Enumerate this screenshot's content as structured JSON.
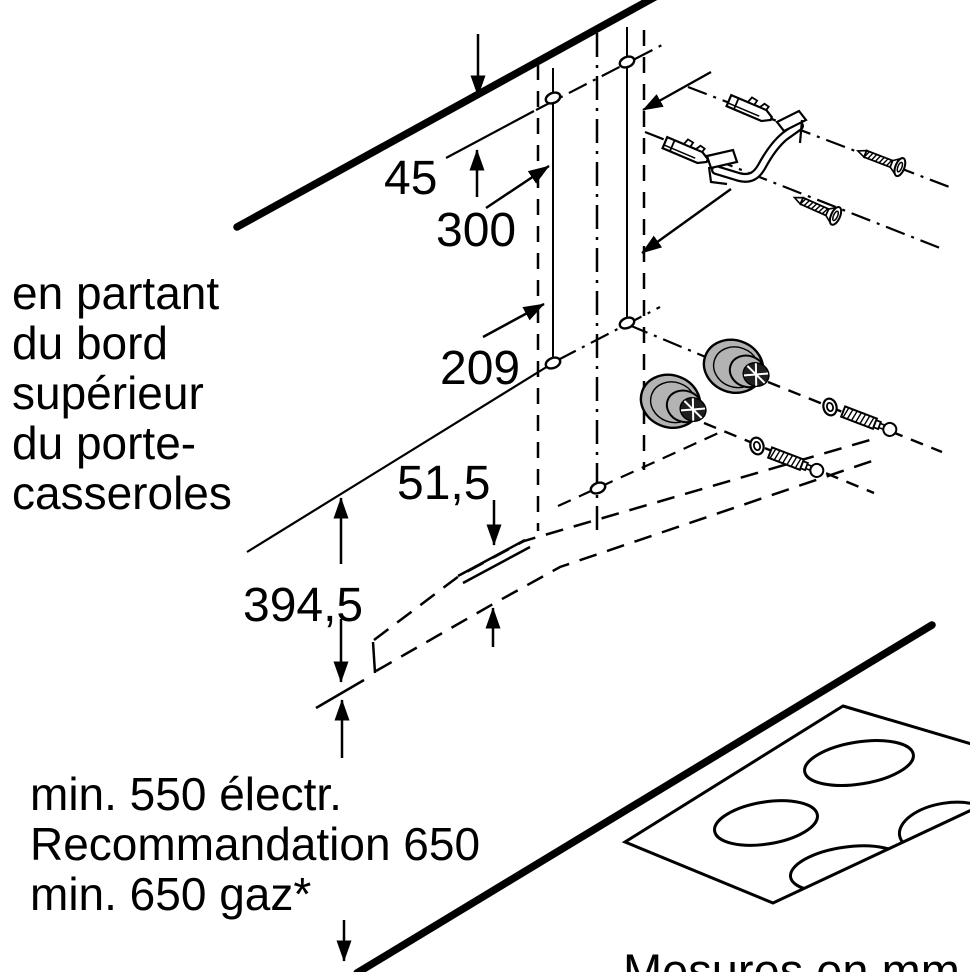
{
  "diagram": {
    "dimensions": {
      "top_offset": "45",
      "hole_spacing": "300",
      "mid_offset": "209",
      "bottom_edge": "51,5",
      "pan_rest_offset": "394,5"
    },
    "notes": {
      "left": [
        "en partant",
        "du bord",
        "supérieur",
        "du porte-",
        "casseroles"
      ],
      "clearance": [
        "min. 550 électr.",
        "Recommandation 650",
        "min. 650 gaz*"
      ],
      "units": "Mesures en mm"
    },
    "parts": {
      "wall_plug": "wall-plug",
      "bracket": "mounting-bracket",
      "screw": "screw",
      "spacer": "spacer-knob",
      "washer": "washer",
      "cooktop": "cooktop"
    },
    "colors": {
      "line": "#000000",
      "metal_gray": "#b3b3b3",
      "knob_face": "#1f1f1f",
      "background": "#ffffff"
    }
  }
}
